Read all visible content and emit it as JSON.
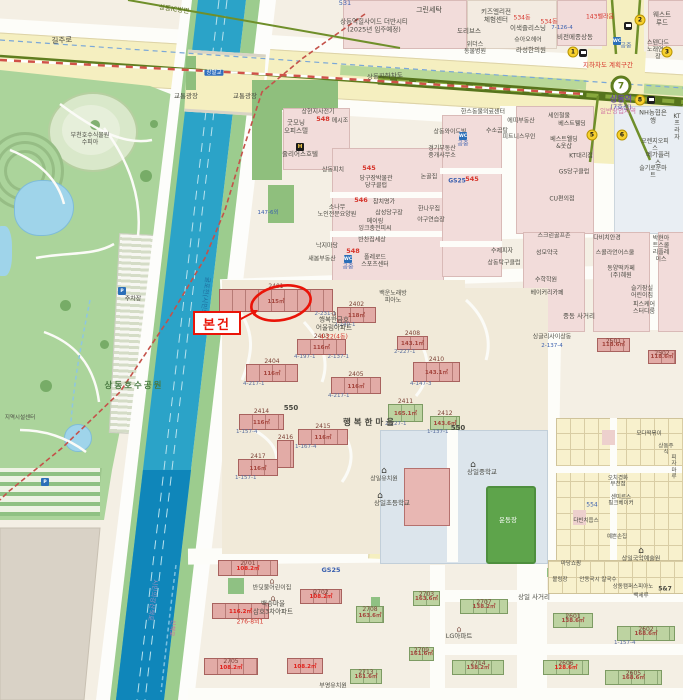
{
  "annotation": {
    "box_label": "본건"
  },
  "station": {
    "line_number": "7",
    "name": "상동역",
    "line_label": "(7호선)"
  },
  "colors": {
    "accent_red": "#ea1408",
    "canal": "#2ba3c8",
    "park": "#abd49b",
    "road_yellow": "#f5efc0",
    "subway_olive": "#56741c",
    "building_pink": "#e2aba6",
    "building_green": "#bdd3a1"
  },
  "labels": [
    {
      "t": "531",
      "x": 345,
      "y": 4,
      "c": "b",
      "s": 6.5
    },
    {
      "t": "그린세탁",
      "x": 429,
      "y": 10,
      "c": "g",
      "s": 7
    },
    {
      "t": "상동역힐사이드 더반시티\n(2025년 입주예정)",
      "x": 374,
      "y": 26,
      "c": "g",
      "s": 6.5
    },
    {
      "t": "키즈엘리전\n체험센터",
      "x": 496,
      "y": 16,
      "c": "g",
      "s": 6.5
    },
    {
      "t": "도리브스",
      "x": 469,
      "y": 32,
      "c": "g",
      "s": 6.5
    },
    {
      "t": "이색즐리스닝",
      "x": 528,
      "y": 29,
      "c": "g",
      "s": 6.5
    },
    {
      "t": "534동",
      "x": 522,
      "y": 18,
      "c": "r",
      "s": 6
    },
    {
      "t": "534동",
      "x": 549,
      "y": 22,
      "c": "r",
      "s": 6
    },
    {
      "t": "7-126-4",
      "x": 562,
      "y": 28,
      "c": "b",
      "s": 5.5
    },
    {
      "t": "비전메종상동",
      "x": 575,
      "y": 38,
      "c": "g",
      "s": 6.5
    },
    {
      "t": "143벨라움",
      "x": 600,
      "y": 17,
      "c": "r",
      "s": 6
    },
    {
      "t": "웨스트루드",
      "x": 662,
      "y": 19,
      "c": "g",
      "s": 6.5
    },
    {
      "t": "스텐다드\n노래연습장",
      "x": 658,
      "y": 50,
      "c": "g",
      "s": 6
    },
    {
      "t": "상동IC방면",
      "x": 174,
      "y": 10,
      "c": "o",
      "s": 6.5,
      "r": 8
    },
    {
      "t": "길주로",
      "x": 62,
      "y": 41,
      "c": "g",
      "s": 7.5,
      "r": -4
    },
    {
      "t": "상동지하차도",
      "x": 385,
      "y": 77,
      "c": "g",
      "s": 6.5,
      "r": -3
    },
    {
      "t": "지하차도 계획구간",
      "x": 608,
      "y": 66,
      "c": "r",
      "s": 6.5
    },
    {
      "t": "일반상업지역",
      "x": 618,
      "y": 112,
      "c": "pk",
      "s": 6.5
    },
    {
      "t": "교통광장",
      "x": 186,
      "y": 97,
      "c": "g",
      "s": 6.5
    },
    {
      "t": "교통광장",
      "x": 245,
      "y": 97,
      "c": "g",
      "s": 6.5
    },
    {
      "t": "공중",
      "x": 626,
      "y": 46,
      "c": "b",
      "s": 6
    },
    {
      "t": "라성한의원",
      "x": 531,
      "y": 51,
      "c": "g",
      "s": 6.5
    },
    {
      "t": "슈아오헤어",
      "x": 528,
      "y": 40,
      "c": "g",
      "s": 6
    },
    {
      "t": "위더스\n동물병원",
      "x": 475,
      "y": 48,
      "c": "g",
      "s": 6
    },
    {
      "t": "상현지사전기",
      "x": 318,
      "y": 112,
      "c": "g",
      "s": 6
    },
    {
      "t": "굿모닝\n오피스텔",
      "x": 296,
      "y": 127,
      "c": "g",
      "s": 6.5
    },
    {
      "t": "548",
      "x": 323,
      "y": 120,
      "c": "r",
      "s": 6.5,
      "b": 1
    },
    {
      "t": "메시조",
      "x": 340,
      "y": 121,
      "c": "g",
      "s": 6
    },
    {
      "t": "줄리어스호텔",
      "x": 300,
      "y": 155,
      "c": "g",
      "s": 6.5
    },
    {
      "t": "NH농협은행",
      "x": 653,
      "y": 117,
      "c": "g",
      "s": 6.5
    },
    {
      "t": "KT프라자",
      "x": 677,
      "y": 127,
      "c": "g",
      "s": 6
    },
    {
      "t": "오렌지오피스",
      "x": 655,
      "y": 145,
      "c": "g",
      "s": 6
    },
    {
      "t": "메가플러스",
      "x": 658,
      "y": 159,
      "c": "g",
      "s": 6.5
    },
    {
      "t": "슬기로운마트",
      "x": 653,
      "y": 172,
      "c": "g",
      "s": 6
    },
    {
      "t": "한스동물의료센터",
      "x": 483,
      "y": 112,
      "c": "g",
      "s": 6
    },
    {
      "t": "에띠부동산",
      "x": 521,
      "y": 121,
      "c": "g",
      "s": 6
    },
    {
      "t": "수소곰탕",
      "x": 497,
      "y": 131,
      "c": "g",
      "s": 6
    },
    {
      "t": "피트니스무인",
      "x": 519,
      "y": 137,
      "c": "g",
      "s": 6
    },
    {
      "t": "공중",
      "x": 463,
      "y": 144,
      "c": "b",
      "s": 6
    },
    {
      "t": "세인철물",
      "x": 559,
      "y": 116,
      "c": "g",
      "s": 6
    },
    {
      "t": "베스트웰딩",
      "x": 572,
      "y": 124,
      "c": "g",
      "s": 6
    },
    {
      "t": "베스트웰딩\n&옷샵",
      "x": 564,
      "y": 143,
      "c": "g",
      "s": 6
    },
    {
      "t": "KT대리점",
      "x": 581,
      "y": 156,
      "c": "g",
      "s": 6
    },
    {
      "t": "GS당구클럽",
      "x": 574,
      "y": 172,
      "c": "g",
      "s": 6
    },
    {
      "t": "CU편의점",
      "x": 562,
      "y": 199,
      "c": "g",
      "s": 6
    },
    {
      "t": "GS25",
      "x": 457,
      "y": 181,
      "c": "b",
      "s": 6,
      "b": 1
    },
    {
      "t": "545",
      "x": 472,
      "y": 180,
      "c": "r",
      "s": 6.5,
      "b": 1
    },
    {
      "t": "상동와이드빌",
      "x": 450,
      "y": 132,
      "c": "g",
      "s": 6
    },
    {
      "t": "경기부동산\n중개사무소",
      "x": 442,
      "y": 152,
      "c": "g",
      "s": 6
    },
    {
      "t": "상동피치",
      "x": 333,
      "y": 170,
      "c": "g",
      "s": 6
    },
    {
      "t": "545",
      "x": 369,
      "y": 169,
      "c": "r",
      "s": 6.5,
      "b": 1
    },
    {
      "t": "당구장박물관\n당구클럽",
      "x": 376,
      "y": 182,
      "c": "g",
      "s": 6
    },
    {
      "t": "논골집",
      "x": 429,
      "y": 177,
      "c": "g",
      "s": 6
    },
    {
      "t": "546",
      "x": 361,
      "y": 201,
      "c": "r",
      "s": 6.5,
      "b": 1
    },
    {
      "t": "참치명가",
      "x": 384,
      "y": 202,
      "c": "g",
      "s": 6
    },
    {
      "t": "삼성당구장",
      "x": 389,
      "y": 213,
      "c": "g",
      "s": 6
    },
    {
      "t": "한나무집",
      "x": 429,
      "y": 209,
      "c": "g",
      "s": 6
    },
    {
      "t": "소나무\n노인전문요양원",
      "x": 337,
      "y": 211,
      "c": "g",
      "s": 6
    },
    {
      "t": "메이링\n잉크충전피씨",
      "x": 375,
      "y": 225,
      "c": "g",
      "s": 6
    },
    {
      "t": "야구연습장",
      "x": 431,
      "y": 220,
      "c": "g",
      "s": 6
    },
    {
      "t": "낙지마당",
      "x": 327,
      "y": 246,
      "c": "g",
      "s": 6
    },
    {
      "t": "반찬집세상",
      "x": 372,
      "y": 240,
      "c": "g",
      "s": 6
    },
    {
      "t": "548",
      "x": 353,
      "y": 252,
      "c": "r",
      "s": 6.5,
      "b": 1
    },
    {
      "t": "폴레로드\n스포츠센터",
      "x": 375,
      "y": 261,
      "c": "g",
      "s": 6
    },
    {
      "t": "수제피자",
      "x": 502,
      "y": 251,
      "c": "g",
      "s": 6
    },
    {
      "t": "상동탁구클럽",
      "x": 504,
      "y": 263,
      "c": "g",
      "s": 6
    },
    {
      "t": "새봄부동산",
      "x": 322,
      "y": 259,
      "c": "g",
      "s": 6
    },
    {
      "t": "공중",
      "x": 348,
      "y": 267,
      "c": "b",
      "s": 6
    },
    {
      "t": "147-6외",
      "x": 268,
      "y": 213,
      "c": "b",
      "s": 5.5
    },
    {
      "t": "백운노래방\n피아노",
      "x": 393,
      "y": 297,
      "c": "g",
      "s": 6
    },
    {
      "t": "행복한금호\n어울림아파트",
      "x": 334,
      "y": 324,
      "c": "g",
      "s": 6.5
    },
    {
      "t": "4-22(4동)",
      "x": 334,
      "y": 337,
      "c": "r",
      "s": 6
    },
    {
      "t": "중동 사거리",
      "x": 579,
      "y": 317,
      "c": "g",
      "s": 6.5
    },
    {
      "t": "다비치안경",
      "x": 607,
      "y": 238,
      "c": "g",
      "s": 6
    },
    {
      "t": "스콜라언어스쿨",
      "x": 615,
      "y": 253,
      "c": "g",
      "s": 6
    },
    {
      "t": "박현아트스쿨\n리플레이스",
      "x": 661,
      "y": 249,
      "c": "g",
      "s": 6
    },
    {
      "t": "동양떡카페\n(주)혜원",
      "x": 621,
      "y": 272,
      "c": "g",
      "s": 6
    },
    {
      "t": "슬기잠실\n어린이집",
      "x": 642,
      "y": 292,
      "c": "g",
      "s": 6
    },
    {
      "t": "피스케어\n스터디룸",
      "x": 644,
      "y": 308,
      "c": "g",
      "s": 6
    },
    {
      "t": "스크린골프존",
      "x": 554,
      "y": 236,
      "c": "g",
      "s": 6
    },
    {
      "t": "성모약국",
      "x": 547,
      "y": 253,
      "c": "g",
      "s": 6
    },
    {
      "t": "수학학원",
      "x": 546,
      "y": 280,
      "c": "g",
      "s": 6
    },
    {
      "t": "베이커리카페",
      "x": 547,
      "y": 293,
      "c": "g",
      "s": 6
    },
    {
      "t": "싱글리사이상동",
      "x": 552,
      "y": 337,
      "c": "g",
      "s": 6
    },
    {
      "t": "2-137-4",
      "x": 552,
      "y": 346,
      "c": "b",
      "s": 5.5
    },
    {
      "t": "550",
      "x": 291,
      "y": 408,
      "c": "g",
      "s": 7,
      "b": 1
    },
    {
      "t": "550",
      "x": 458,
      "y": 428,
      "c": "g",
      "s": 7,
      "b": 1
    },
    {
      "t": "행복한마을",
      "x": 370,
      "y": 423,
      "c": "g",
      "s": 8.5,
      "b": 1,
      "ls": 3
    },
    {
      "t": "상일유치원",
      "x": 384,
      "y": 479,
      "c": "g",
      "s": 6
    },
    {
      "t": "상일초등학교",
      "x": 392,
      "y": 504,
      "c": "g",
      "s": 6.5
    },
    {
      "t": "상일중학교",
      "x": 482,
      "y": 473,
      "c": "g",
      "s": 6.5
    },
    {
      "t": "운동장",
      "x": 508,
      "y": 521,
      "c": "w",
      "s": 6.5
    },
    {
      "t": "상일국악예술원",
      "x": 641,
      "y": 559,
      "c": "g",
      "s": 6
    },
    {
      "t": "주차장",
      "x": 133,
      "y": 299,
      "c": "g",
      "s": 6
    },
    {
      "t": "상동호수공원",
      "x": 134,
      "y": 386,
      "c": "gr",
      "s": 8.5,
      "b": 1,
      "ls": 2
    },
    {
      "t": "부천호수식물원\n수피아",
      "x": 90,
      "y": 139,
      "c": "g",
      "s": 6
    },
    {
      "t": "지역시설센터",
      "x": 20,
      "y": 418,
      "c": "g",
      "s": 5.5
    },
    {
      "t": "굴포천(시민의강)",
      "x": 204,
      "y": 300,
      "c": "ca",
      "s": 6.5,
      "r": 97
    },
    {
      "t": "시민의강산책로",
      "x": 152,
      "y": 600,
      "c": "la",
      "s": 6.5,
      "r": 97
    },
    {
      "t": "산책로",
      "x": 172,
      "y": 628,
      "c": "pk",
      "s": 6,
      "r": 97
    },
    {
      "t": "GS25",
      "x": 331,
      "y": 571,
      "c": "b",
      "s": 6.5,
      "b": 1
    },
    {
      "t": "상일 사거리",
      "x": 534,
      "y": 598,
      "c": "g",
      "s": 6.5
    },
    {
      "t": "반딧불어린이집",
      "x": 272,
      "y": 588,
      "c": "g",
      "s": 6
    },
    {
      "t": "백송마을\n삼호3차아파트",
      "x": 273,
      "y": 608,
      "c": "g",
      "s": 6.5
    },
    {
      "t": "276-8외1",
      "x": 250,
      "y": 622,
      "c": "r",
      "s": 6
    },
    {
      "t": "부영유치원",
      "x": 333,
      "y": 686,
      "c": "g",
      "s": 6
    },
    {
      "t": "LG아파트",
      "x": 459,
      "y": 637,
      "c": "g",
      "s": 6.5
    },
    {
      "t": "마당쇼핑",
      "x": 571,
      "y": 564,
      "c": "g",
      "s": 5.5
    },
    {
      "t": "볼링장",
      "x": 560,
      "y": 580,
      "c": "g",
      "s": 5.5
    },
    {
      "t": "안동국시 칼국수",
      "x": 598,
      "y": 580,
      "c": "g",
      "s": 5.5
    },
    {
      "t": "상동캠퍼스피아노",
      "x": 633,
      "y": 587,
      "c": "g",
      "s": 5.5
    },
    {
      "t": "백세루",
      "x": 641,
      "y": 596,
      "c": "g",
      "s": 5.5
    },
    {
      "t": "5&7",
      "x": 665,
      "y": 589,
      "c": "g",
      "s": 6,
      "b": 1
    },
    {
      "t": "모다떡볶이",
      "x": 649,
      "y": 434,
      "c": "g",
      "s": 5.5
    },
    {
      "t": "상동주식",
      "x": 666,
      "y": 450,
      "c": "g",
      "s": 5.5
    },
    {
      "t": "오치경화\n부천점",
      "x": 618,
      "y": 482,
      "c": "g",
      "s": 5.5
    },
    {
      "t": "센미르스\n핑크베이커",
      "x": 621,
      "y": 501,
      "c": "g",
      "s": 5.5
    },
    {
      "t": "다빈치웁스",
      "x": 586,
      "y": 521,
      "c": "g",
      "s": 5.5
    },
    {
      "t": "예쁜손집",
      "x": 617,
      "y": 537,
      "c": "g",
      "s": 5.5
    },
    {
      "t": "피자마루",
      "x": 674,
      "y": 468,
      "c": "g",
      "s": 5.5
    },
    {
      "t": "554",
      "x": 592,
      "y": 505,
      "c": "b",
      "s": 6
    },
    {
      "t": "장말교",
      "x": 214,
      "y": 73,
      "c": "w",
      "s": 5.5,
      "sign": 1
    }
  ],
  "buildings": [
    {
      "x": 219,
      "y": 289,
      "w": 112,
      "h": 21,
      "num": "2401",
      "area": "115㎡",
      "lot": "4-249-3",
      "lot2": "2-231-1"
    },
    {
      "x": 337,
      "y": 307,
      "w": 37,
      "h": 14,
      "num": "2402",
      "area": "118㎡",
      "lot": "2-240-1"
    },
    {
      "x": 297,
      "y": 339,
      "w": 47,
      "h": 14,
      "num": "2403",
      "area": "116㎡",
      "lot": "4-197-1",
      "lot2": "2-137-1"
    },
    {
      "x": 246,
      "y": 364,
      "w": 50,
      "h": 16,
      "num": "2404",
      "area": "116㎡",
      "lot": "4-217-1"
    },
    {
      "x": 331,
      "y": 377,
      "w": 48,
      "h": 15,
      "num": "2405",
      "area": "116㎡",
      "lot": "4-217-1"
    },
    {
      "x": 397,
      "y": 336,
      "w": 29,
      "h": 12,
      "num": "2408",
      "area": "143.1㎡",
      "lot": "2-227-1"
    },
    {
      "x": 413,
      "y": 362,
      "w": 45,
      "h": 18,
      "num": "2410",
      "area": "143.1㎡",
      "lot": "4-147-3"
    },
    {
      "x": 388,
      "y": 404,
      "w": 33,
      "h": 16,
      "num": "2411",
      "area": "165.1㎡",
      "lot": "2-227-1",
      "g": 1
    },
    {
      "x": 430,
      "y": 416,
      "w": 28,
      "h": 12,
      "num": "2412",
      "area": "143.6㎡",
      "lot": "1-137-1",
      "g": 1
    },
    {
      "x": 239,
      "y": 414,
      "w": 43,
      "h": 14,
      "num": "2414",
      "area": "116㎡",
      "lot": "1-157-4"
    },
    {
      "x": 298,
      "y": 429,
      "w": 48,
      "h": 14,
      "num": "2415",
      "area": "116㎡",
      "lot": "1-167-4"
    },
    {
      "x": 277,
      "y": 440,
      "w": 15,
      "h": 26,
      "num": "2416",
      "area": "",
      "lot": ""
    },
    {
      "x": 238,
      "y": 459,
      "w": 38,
      "h": 15,
      "num": "2417",
      "area": "116㎡",
      "lot": "1-157-1"
    },
    {
      "x": 218,
      "y": 560,
      "w": 58,
      "h": 14,
      "num": "2701",
      "area": "108.2㎡",
      "in": 1,
      "red": 1
    },
    {
      "x": 212,
      "y": 603,
      "w": 55,
      "h": 14,
      "num": "",
      "area": "116.2㎡",
      "in": 1,
      "red": 1
    },
    {
      "x": 300,
      "y": 589,
      "w": 40,
      "h": 13,
      "num": "2702",
      "area": "108.2㎡",
      "in": 1,
      "red": 1
    },
    {
      "x": 287,
      "y": 658,
      "w": 34,
      "h": 14,
      "num": "",
      "area": "108.2㎡",
      "in": 1,
      "red": 1
    },
    {
      "x": 204,
      "y": 658,
      "w": 52,
      "h": 15,
      "num": "2705",
      "area": "108.2㎡",
      "in": 1,
      "red": 1
    },
    {
      "x": 413,
      "y": 591,
      "w": 25,
      "h": 13,
      "num": "2703",
      "area": "163.6㎡",
      "in": 1,
      "g": 1
    },
    {
      "x": 356,
      "y": 606,
      "w": 26,
      "h": 15,
      "num": "2708",
      "area": "163.6㎡",
      "in": 1,
      "g": 1
    },
    {
      "x": 350,
      "y": 669,
      "w": 30,
      "h": 13,
      "num": "2713",
      "area": "161.6㎡",
      "in": 1,
      "g": 1
    },
    {
      "x": 409,
      "y": 647,
      "w": 23,
      "h": 12,
      "num": "2709",
      "area": "161.6㎡",
      "in": 1,
      "g": 1
    },
    {
      "x": 597,
      "y": 338,
      "w": 31,
      "h": 12,
      "num": "2501",
      "area": "118.6㎡",
      "in": 1
    },
    {
      "x": 648,
      "y": 350,
      "w": 26,
      "h": 12,
      "num": "2502",
      "area": "118.6㎡",
      "in": 1
    },
    {
      "x": 553,
      "y": 613,
      "w": 38,
      "h": 13,
      "num": "2601",
      "area": "138.6㎡",
      "in": 1,
      "g": 1
    },
    {
      "x": 617,
      "y": 626,
      "w": 56,
      "h": 13,
      "num": "2602",
      "area": "168.6㎡",
      "lot": "1-157-4",
      "in": 1,
      "g": 1
    },
    {
      "x": 605,
      "y": 670,
      "w": 55,
      "h": 13,
      "num": "2605",
      "area": "168.6㎡",
      "in": 1,
      "g": 1
    },
    {
      "x": 543,
      "y": 660,
      "w": 44,
      "h": 13,
      "num": "2606",
      "area": "128.6㎡",
      "in": 1,
      "g": 1,
      "red": 1
    },
    {
      "x": 460,
      "y": 599,
      "w": 46,
      "h": 13,
      "num": "2707",
      "area": "138.2㎡",
      "in": 1,
      "g": 1
    },
    {
      "x": 452,
      "y": 660,
      "w": 50,
      "h": 13,
      "num": "2714",
      "area": "138.2㎡",
      "in": 1,
      "g": 1
    }
  ],
  "exits": [
    {
      "n": "1",
      "x": 573,
      "y": 52
    },
    {
      "n": "2",
      "x": 640,
      "y": 20
    },
    {
      "n": "3",
      "x": 667,
      "y": 52
    },
    {
      "n": "8",
      "x": 640,
      "y": 100
    },
    {
      "n": "5",
      "x": 592,
      "y": 135
    },
    {
      "n": "6",
      "x": 622,
      "y": 135
    }
  ],
  "bus_stops": [
    {
      "x": 583,
      "y": 53
    },
    {
      "x": 628,
      "y": 26
    },
    {
      "x": 651,
      "y": 100
    }
  ],
  "icons": [
    {
      "x": 617,
      "y": 41,
      "k": "wc",
      "t": "WC"
    },
    {
      "x": 463,
      "y": 136,
      "k": "wc",
      "t": "WC"
    },
    {
      "x": 348,
      "y": 259,
      "k": "wc",
      "t": "WC"
    },
    {
      "x": 122,
      "y": 291,
      "k": "p",
      "t": "P"
    },
    {
      "x": 45,
      "y": 482,
      "k": "p",
      "t": "P"
    },
    {
      "x": 300,
      "y": 147,
      "k": "hotel",
      "t": "H"
    },
    {
      "x": 384,
      "y": 471,
      "k": "sch",
      "t": "⌂"
    },
    {
      "x": 380,
      "y": 496,
      "k": "sch",
      "t": "⌂"
    },
    {
      "x": 473,
      "y": 465,
      "k": "sch",
      "t": "⌂"
    },
    {
      "x": 641,
      "y": 551,
      "k": "sch",
      "t": "⌂"
    },
    {
      "x": 334,
      "y": 313,
      "k": "apt",
      "t": "⌂"
    },
    {
      "x": 273,
      "y": 598,
      "k": "apt",
      "t": "⌂"
    },
    {
      "x": 459,
      "y": 629,
      "k": "apt",
      "t": "⌂"
    },
    {
      "x": 272,
      "y": 581,
      "k": "apt",
      "t": "⌂"
    }
  ]
}
